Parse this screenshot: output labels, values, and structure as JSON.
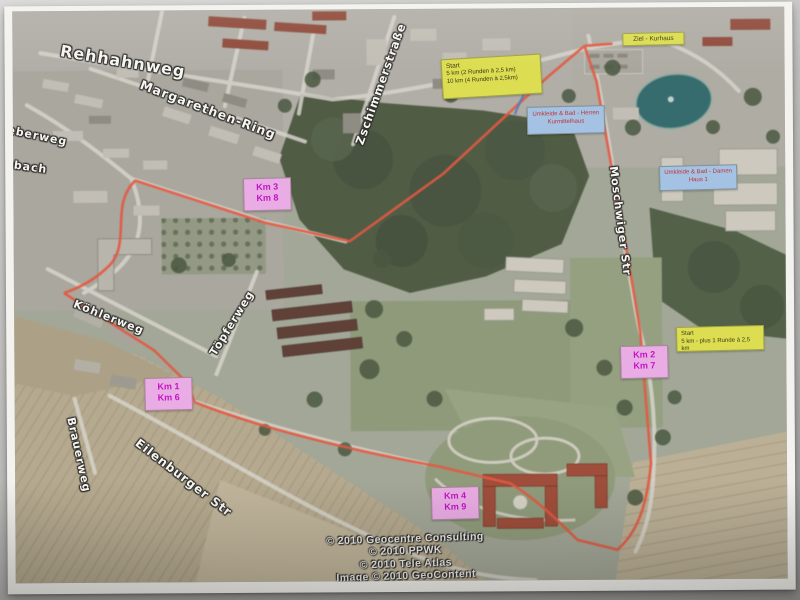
{
  "streets": {
    "rehhahnweg": "Rehhahnweg",
    "margarethen_ring": "Margarethen-Ring",
    "zschimmerstrasse": "Zschimmerstraße",
    "moschwiger_str": "Moschwiger Str",
    "koehlerweg": "Köhlerweg",
    "toepferweg": "Töpferweg",
    "brauerweg": "Brauerweg",
    "eilenburger_str": "Eilenburger Str",
    "beberweg_partial": "beberweg",
    "hbach_partial": "hbach"
  },
  "markers": {
    "start_main": {
      "title": "Start",
      "line1": "5 km (2 Runden à 2,5 km)",
      "line2": "10 km (4 Runden à 2,5km)"
    },
    "ziel": {
      "label": "Ziel - Kurhaus"
    },
    "start_right": {
      "title": "Start",
      "line1": "5 km - plus 1 Runde à 2,5 km"
    },
    "umkleide_herren": {
      "line1": "Umkleide & Bad - Herren",
      "line2": "Kurmittelhaus"
    },
    "umkleide_damen": {
      "line1": "Umkleide & Bad - Damen",
      "line2": "Haus 1"
    },
    "km": [
      {
        "line1": "Km 3",
        "line2": "Km 8"
      },
      {
        "line1": "Km 1",
        "line2": "Km 6"
      },
      {
        "line1": "Km 2",
        "line2": "Km 7"
      },
      {
        "line1": "Km 4",
        "line2": "Km 9"
      }
    ]
  },
  "credits": {
    "line1": "© 2010 Geocentre Consulting",
    "line2": "© 2010 PPWK",
    "line3": "© 2010 Tele Atlas",
    "line4": "Image © 2010 GeoContent"
  },
  "colors": {
    "route_red": "#f0543a",
    "route_blue": "#4a79c8",
    "start_box_yellow": "#dcdd50",
    "km_box_pink": "#e9ace4",
    "km_text_magenta": "#c215c2",
    "info_box_blue": "#a3c2e4",
    "info_text_red": "#c43131",
    "water_teal": "#30696d",
    "field_tan": "#b7aa8b",
    "forest_green": "#4d5a40"
  }
}
